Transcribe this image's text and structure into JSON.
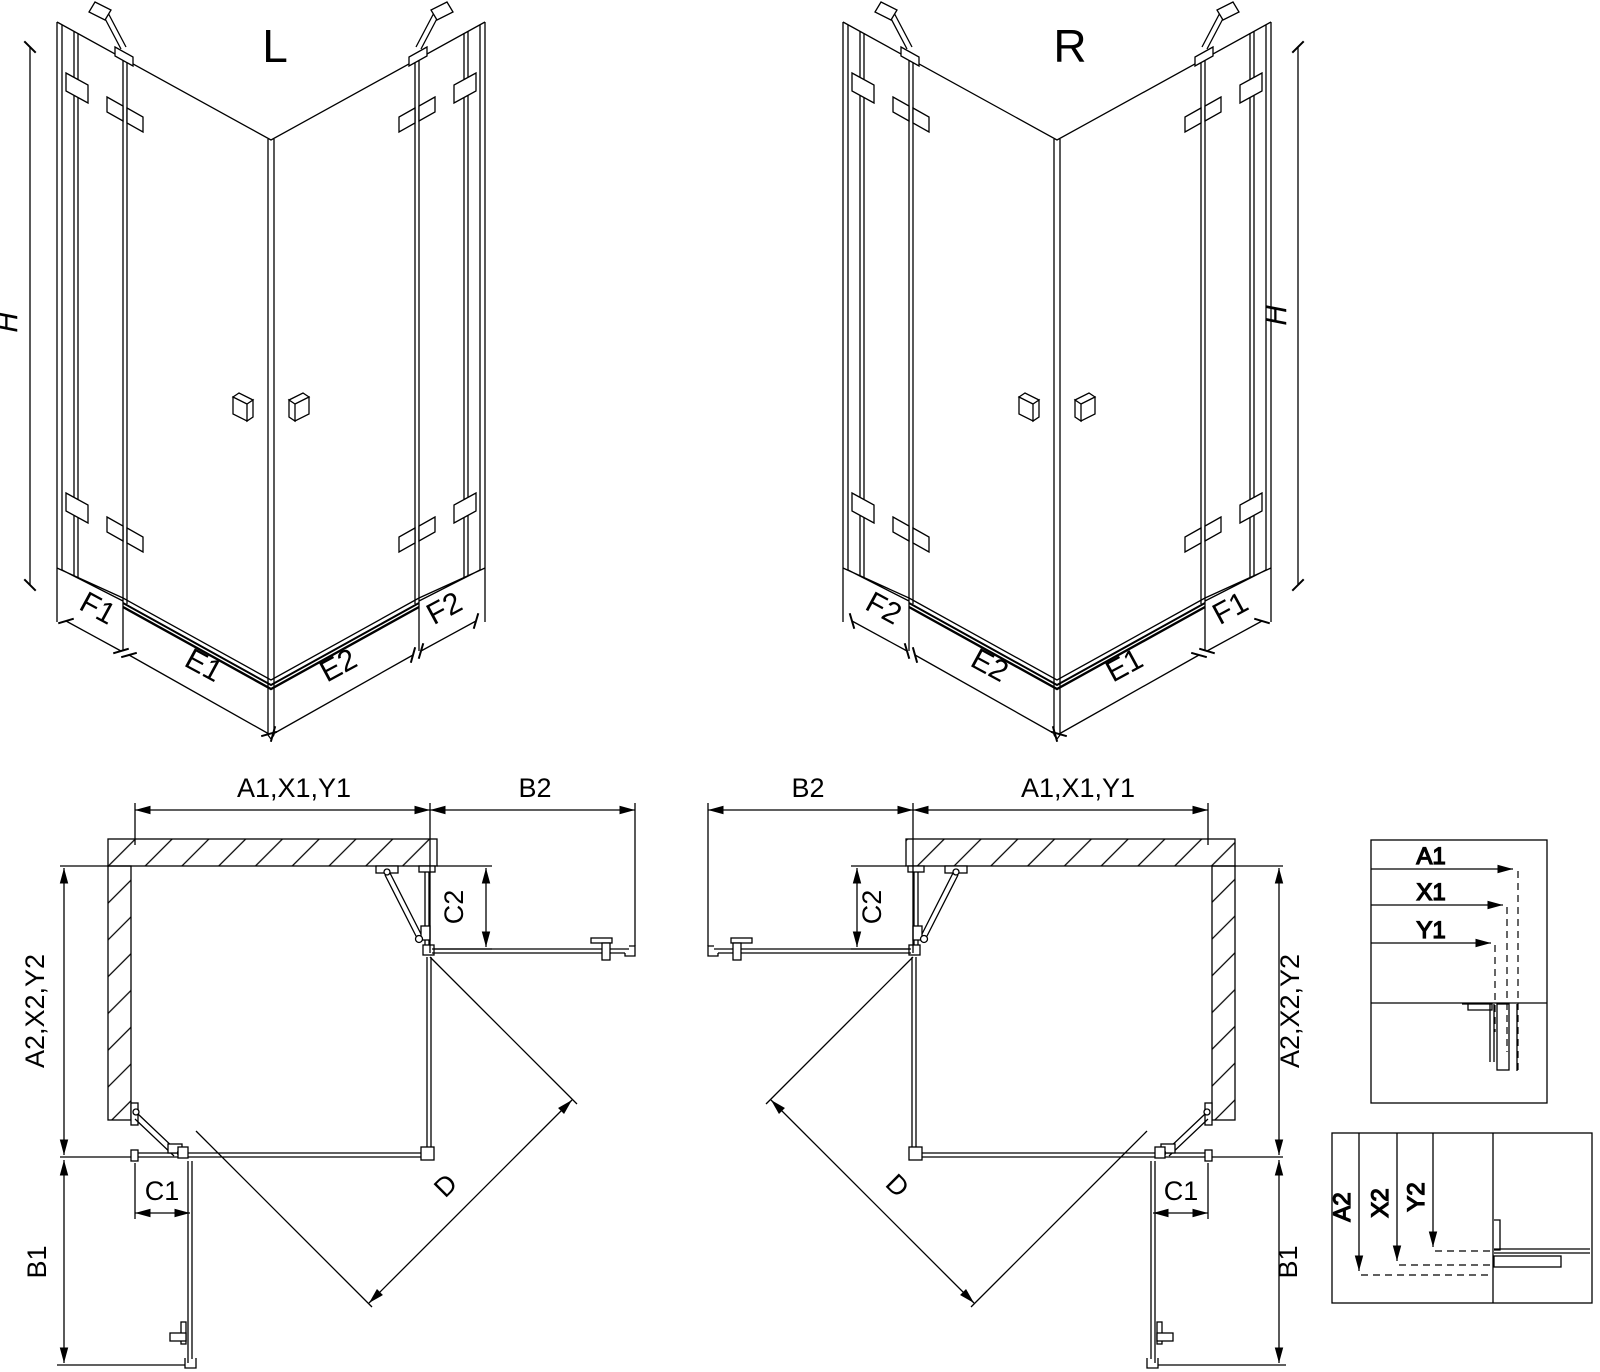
{
  "colors": {
    "line": "#000000",
    "background": "#ffffff"
  },
  "iso_views": {
    "left": {
      "title": "L",
      "height_label": "H",
      "segments": [
        "F1",
        "E1",
        "E2",
        "F2"
      ]
    },
    "right": {
      "title": "R",
      "height_label": "H",
      "segments": [
        "F2",
        "E2",
        "E1",
        "F1"
      ]
    }
  },
  "plan_views": {
    "left": {
      "width_label": "A1,X1,Y1",
      "return_width_label": "B2",
      "fixed_top_label": "C2",
      "depth_label": "A2,X2,Y2",
      "fixed_bottom_label": "C1",
      "return_depth_label": "B1",
      "diagonal_label": "D"
    },
    "right": {
      "width_label": "A1,X1,Y1",
      "return_width_label": "B2",
      "fixed_top_label": "C2",
      "depth_label": "A2,X2,Y2",
      "fixed_bottom_label": "C1",
      "return_depth_label": "B1",
      "diagonal_label": "D"
    }
  },
  "detail_views": {
    "width_section": {
      "labels": [
        "A1",
        "X1",
        "Y1"
      ]
    },
    "depth_section": {
      "labels": [
        "A2",
        "X2",
        "Y2"
      ]
    }
  }
}
